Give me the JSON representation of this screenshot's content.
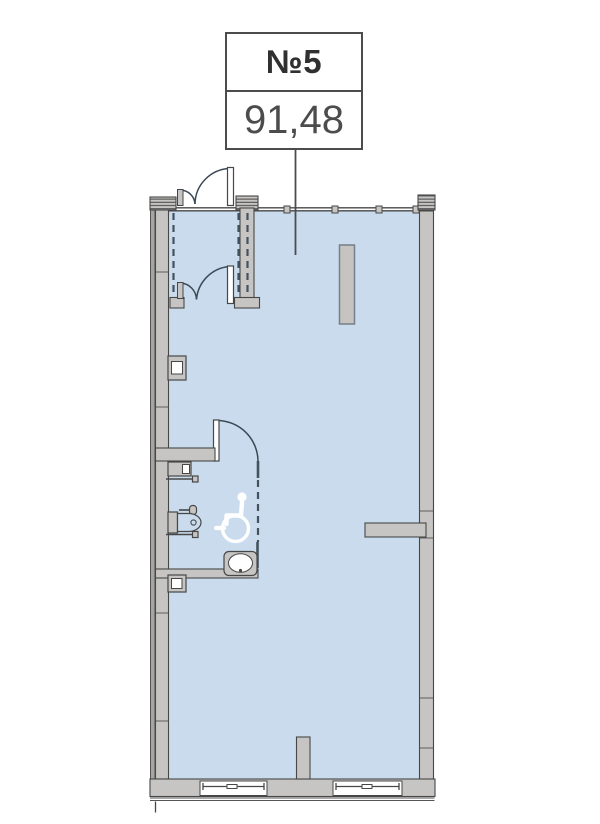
{
  "unit": {
    "number": "№5",
    "area": "91,48"
  },
  "colors": {
    "room_fill": "#c9dbed",
    "wall_fill": "#c6c5c3",
    "wall_outer": "#a6a5a3",
    "outline": "#474747",
    "dash_color": "#44525e",
    "arc_color": "#3c4a57",
    "column_outline": "#74808a",
    "icon_color": "#ffffff",
    "label_border": "#4c4c4c",
    "number_color": "#303030",
    "area_color": "#4c4c4c"
  },
  "icons": {
    "wheelchair_icon": "♿"
  }
}
